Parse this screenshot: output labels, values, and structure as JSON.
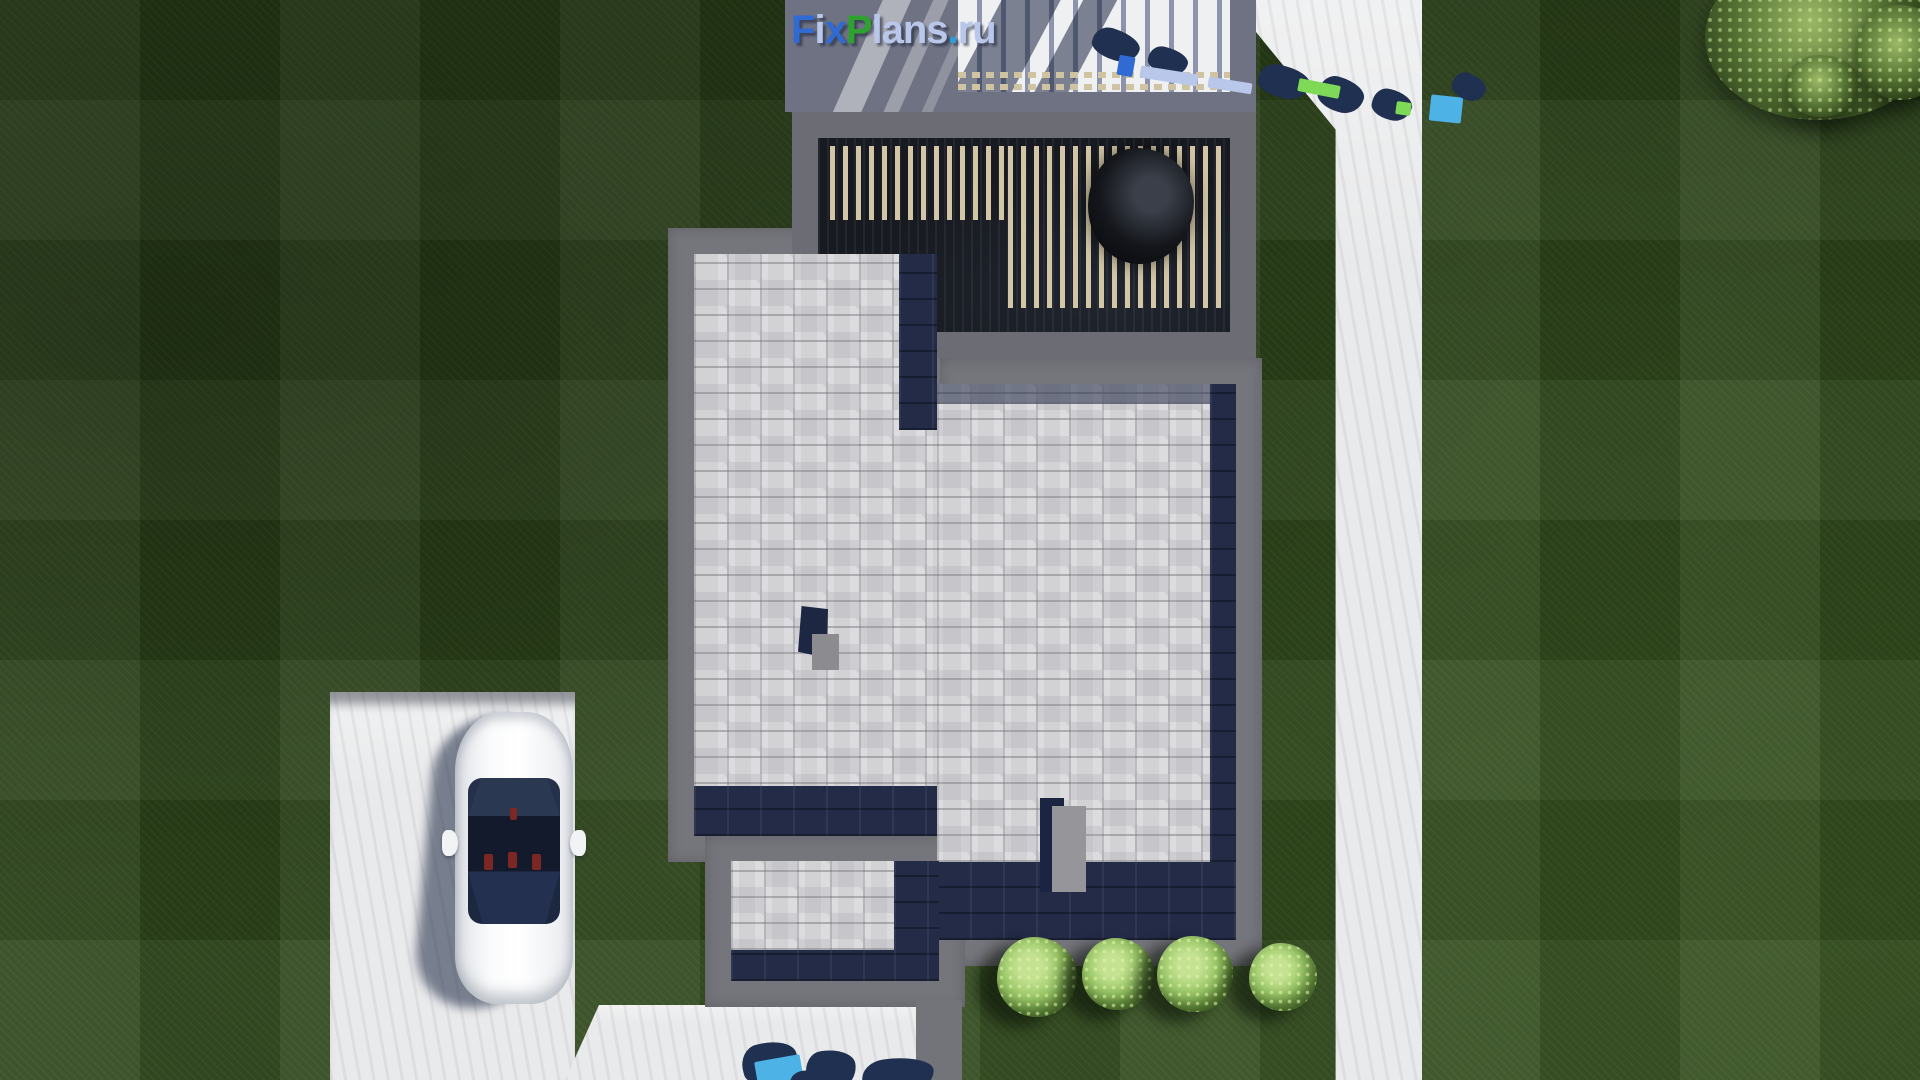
{
  "watermark": {
    "brand_full": "FixPlans.ru",
    "segments": [
      {
        "text": "F",
        "color": "#2f6bd3"
      },
      {
        "text": "i",
        "color": "#b9c7ea"
      },
      {
        "text": "x",
        "color": "#2f6bd3"
      },
      {
        "text": "P",
        "color": "#2ea22e"
      },
      {
        "text": "lans",
        "color": "#b9c7ea"
      },
      {
        "text": ".",
        "color": "#2a9fd8"
      },
      {
        "text": "ru",
        "color": "#b9c7ea"
      }
    ]
  },
  "colors": {
    "grass_base": "#2e461c",
    "grass_highlight": "#4a6a2e",
    "pavement": "#e9eaeb",
    "platform_gray": "#6e7283",
    "parapet_gray": "#75757c",
    "terrace_dark": "#171a20",
    "pergola_slat": "#d3c6a6",
    "shingle_light": "#d2d2d5",
    "shadow_navy": "#232b47",
    "car_white": "#f4f5f6",
    "bush_green": "#9ac768",
    "watermark_navy": "#1f3050",
    "watermark_blue": "#2f6bd3",
    "watermark_green": "#2ea22e",
    "watermark_cyan": "#4db3e6",
    "watermark_periwinkle": "#b9c7ea"
  },
  "scene": {
    "type": "aerial-architectural-render",
    "objects": [
      "lawn",
      "flat-roof-house",
      "slatted-pergola-terrace",
      "gray-shingle-roof",
      "chimneys",
      "driveway",
      "white-car",
      "garden-path",
      "rear-patio",
      "trimmed-bushes",
      "tree-canopy",
      "watermark-logo"
    ]
  }
}
